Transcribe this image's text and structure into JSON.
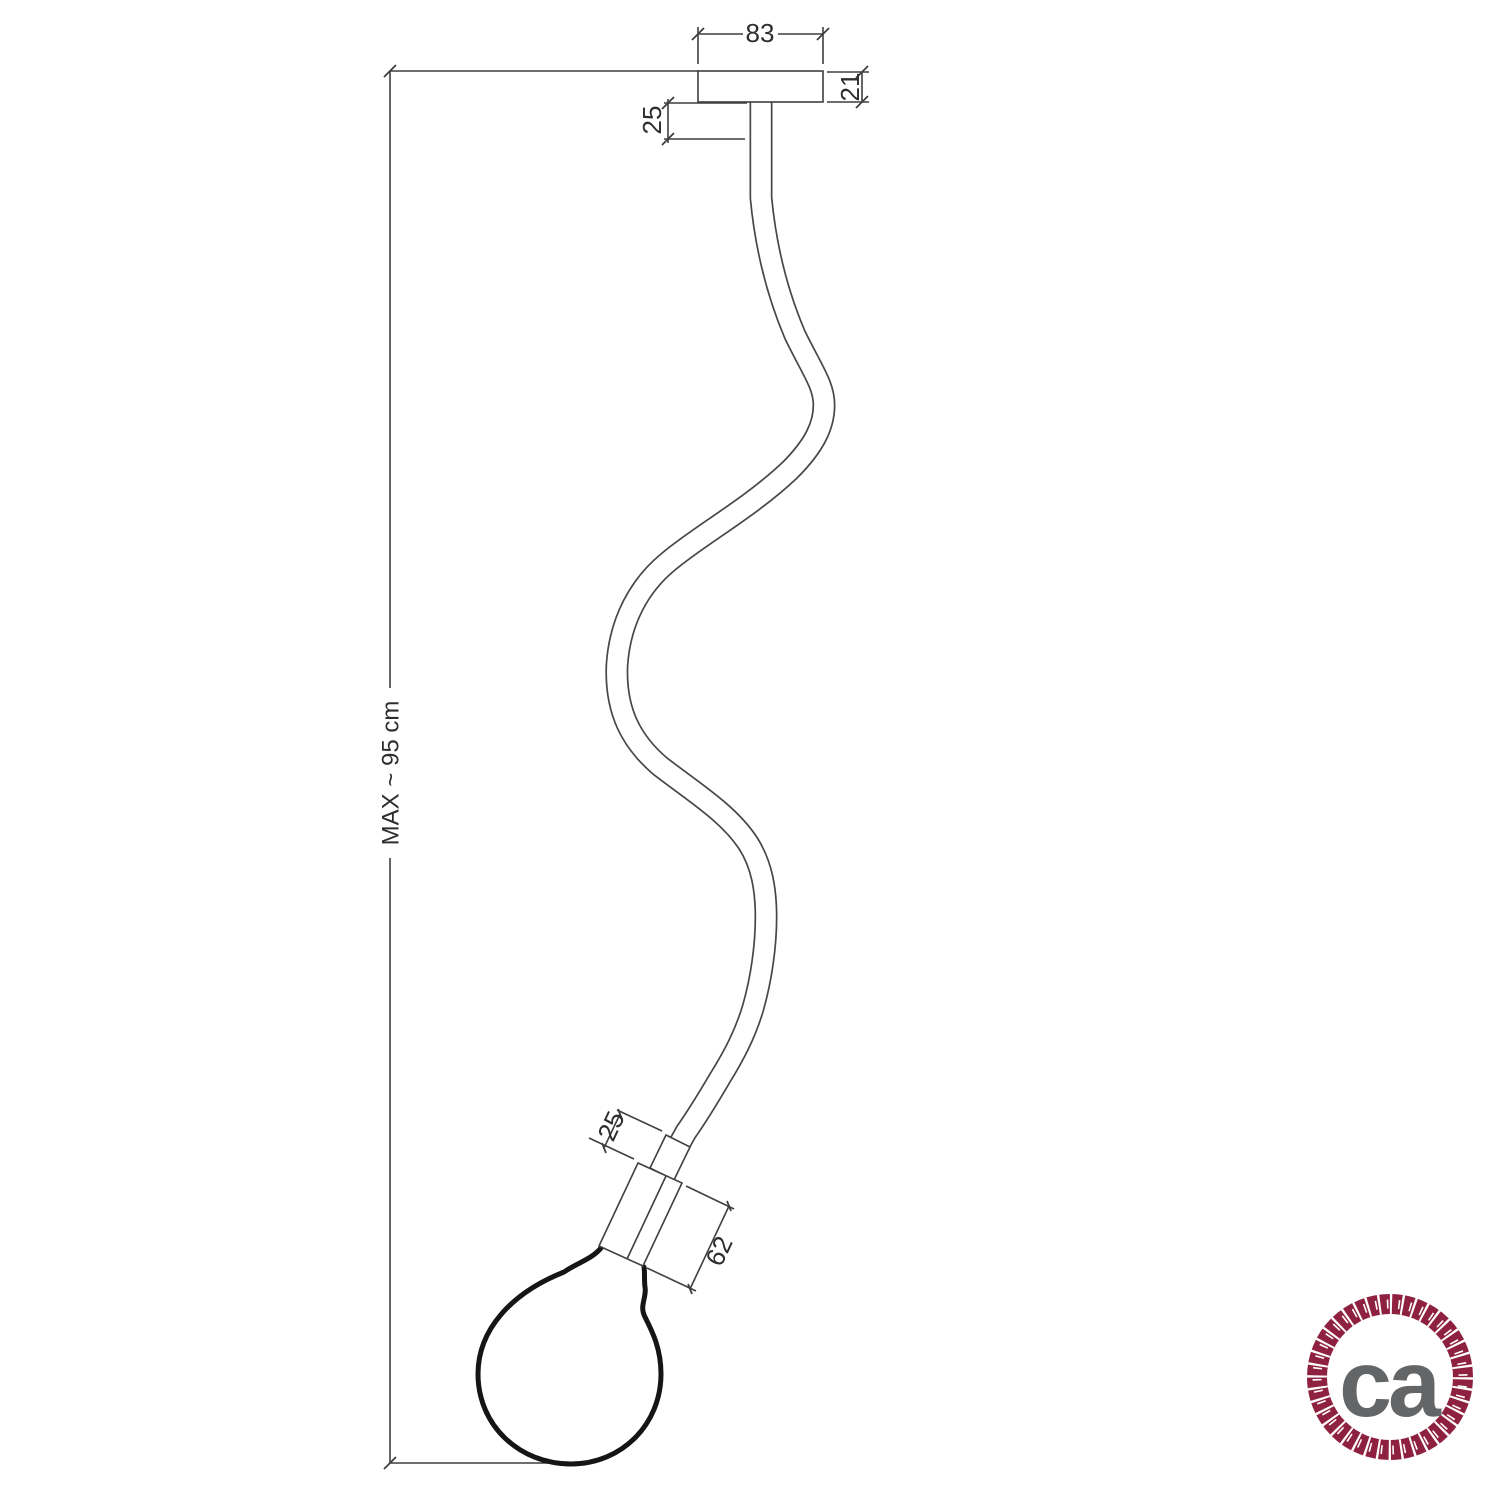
{
  "diagram": {
    "dimensions": {
      "ceiling_rose_width": "83",
      "ceiling_rose_height": "21",
      "top_stem_length": "25",
      "overall_drop": "MAX ~ 95 cm",
      "holder_stem_length": "25",
      "lamp_holder_length": "62"
    },
    "colors": {
      "line": "#3f3f3f",
      "bulb_outline": "#151515"
    }
  },
  "logo": {
    "text": "ca",
    "ring_color": "#8e2040",
    "text_color": "#646567"
  }
}
